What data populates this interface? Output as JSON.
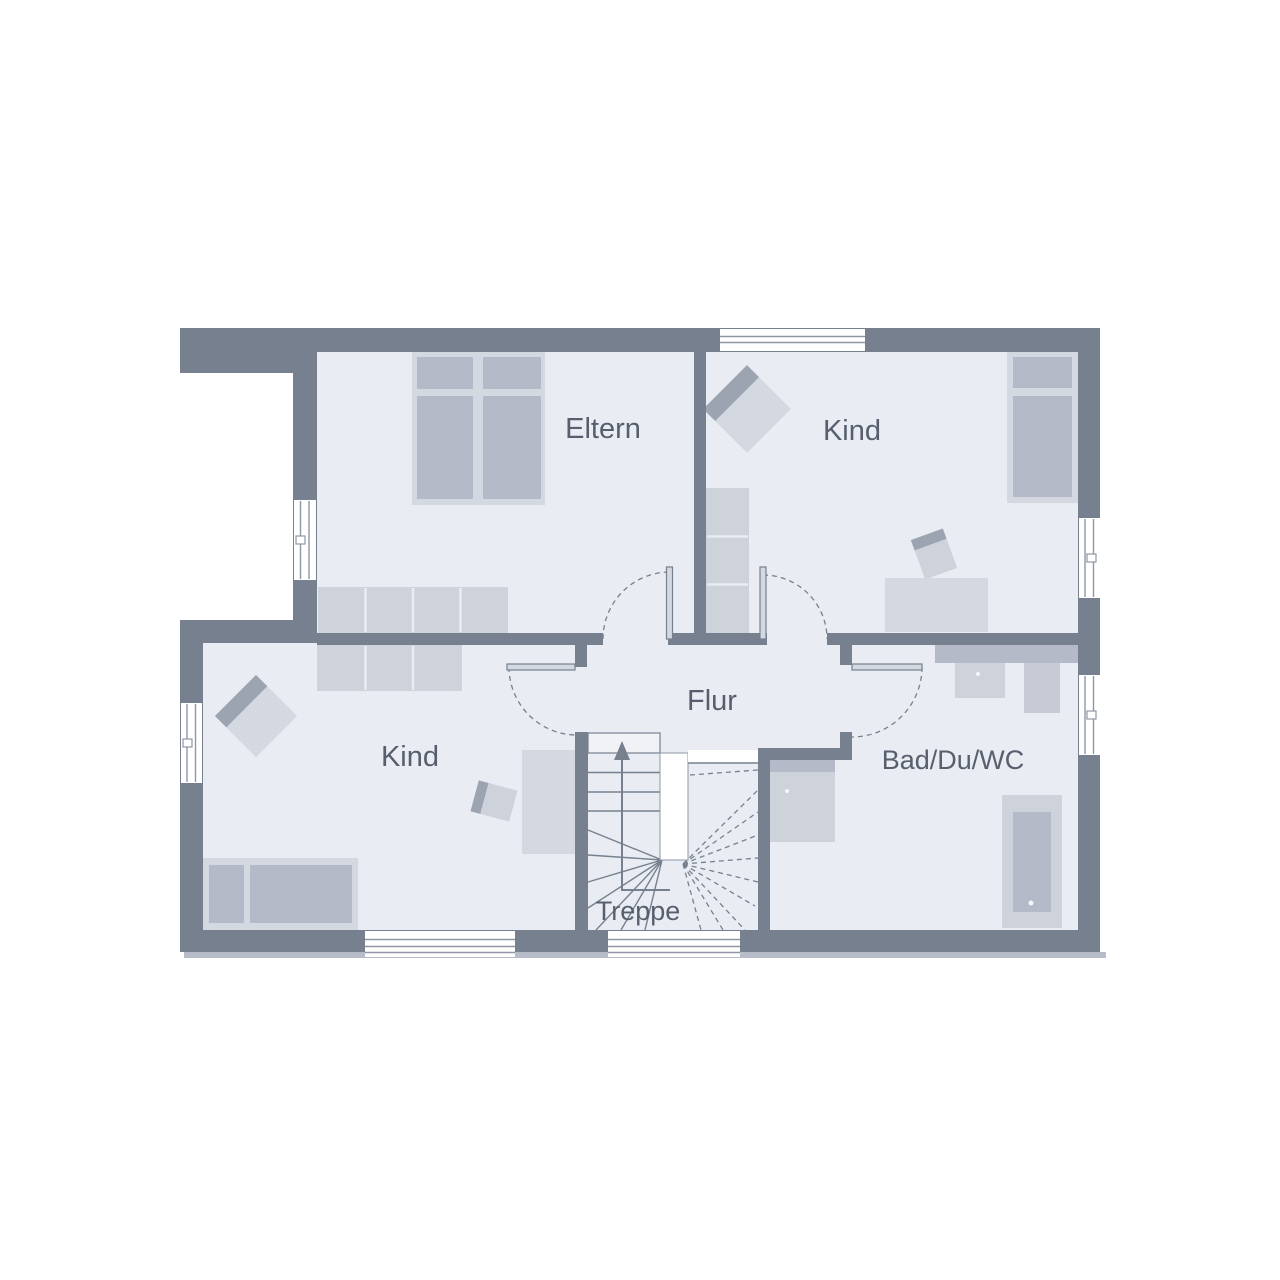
{
  "plan": {
    "type": "floor-plan",
    "rooms": [
      {
        "id": "eltern",
        "label": "Eltern"
      },
      {
        "id": "kind-top",
        "label": "Kind"
      },
      {
        "id": "kind-bottom",
        "label": "Kind"
      },
      {
        "id": "flur",
        "label": "Flur"
      },
      {
        "id": "bad",
        "label": "Bad/Du/WC"
      },
      {
        "id": "treppe",
        "label": "Treppe"
      }
    ],
    "colors": {
      "background": "#FFFFFF",
      "wall": "#76808F",
      "floor": "#E9ECF2",
      "furniture_light": "#D4D8E1",
      "furniture_mid": "#CDD2DB",
      "furniture_mid2": "#C6CBD6",
      "furniture_dark": "#B4BAC7",
      "accent": "#9CA4B2",
      "window_line": "#8F97A5",
      "shadow": "#B7BDC8",
      "label_text": "#575F6E"
    }
  }
}
